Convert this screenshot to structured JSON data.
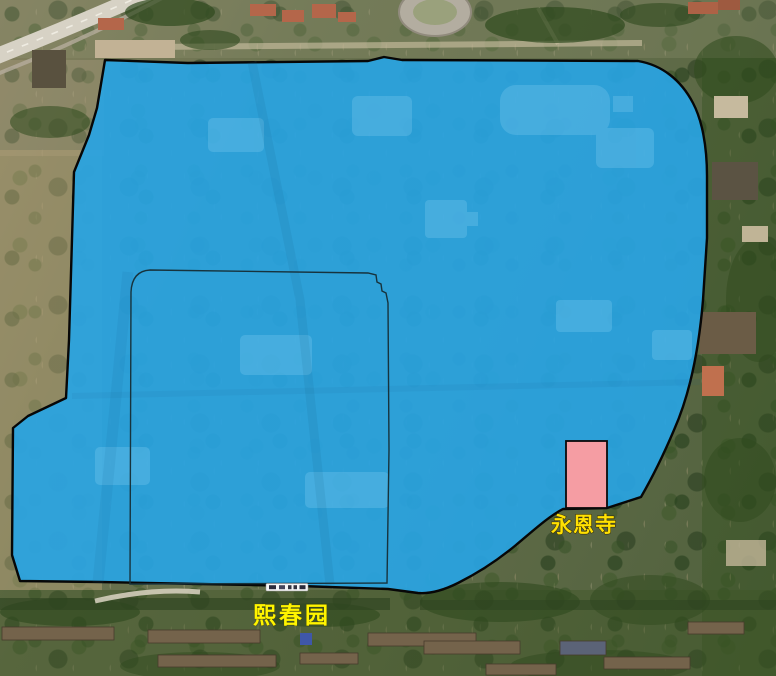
{
  "map": {
    "view": "satellite",
    "labels": [
      {
        "id": "yongensi",
        "text": "永恩寺",
        "color": "#ffe103"
      },
      {
        "id": "xichunyuan",
        "text": "熙春园",
        "color": "#fff500"
      }
    ],
    "regions": {
      "main": {
        "label": "熙春园",
        "fill": "#29a4e2",
        "stroke": "#070707"
      },
      "inner": {
        "label": "inner-boundary",
        "fill": "none",
        "stroke": "#17333d"
      },
      "temple": {
        "label": "永恩寺",
        "fill": "#f59da3",
        "stroke": "#0a0a0a"
      }
    }
  }
}
